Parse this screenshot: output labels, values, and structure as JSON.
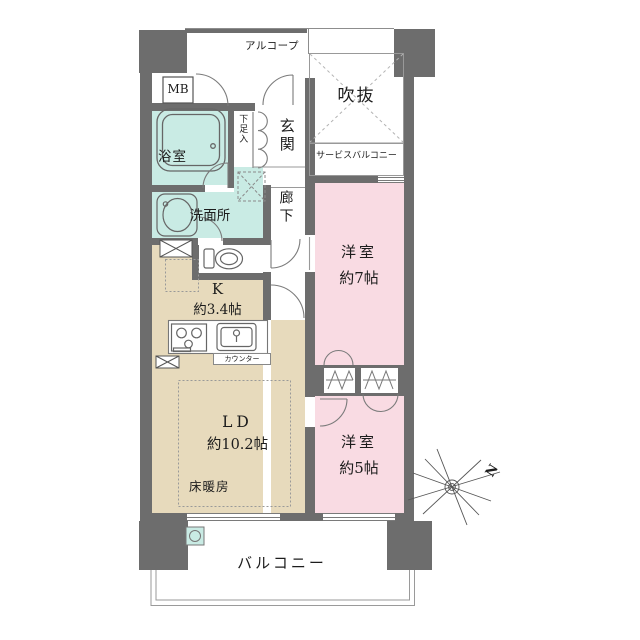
{
  "colors": {
    "wall": "#6d6d6d",
    "room_pink": "#f9dbe3",
    "room_tan": "#e7dabc",
    "room_teal": "#c9ebe4",
    "thin_line": "#8d8d8d",
    "text": "#1c1c1c"
  },
  "rooms": {
    "alcove": {
      "label": "アルコープ"
    },
    "meter_box": {
      "label": "MB"
    },
    "void": {
      "label": "吹抜"
    },
    "service_balcony": {
      "label": "サービスバルコニー"
    },
    "bathroom": {
      "label": "浴室"
    },
    "shoe_cabinet": {
      "label": "下足入"
    },
    "entrance": {
      "label": "玄関"
    },
    "washroom": {
      "label": "洗面所"
    },
    "corridor": {
      "label": "廊下"
    },
    "western_room_7": {
      "label": "洋室",
      "size": "約7帖"
    },
    "kitchen": {
      "label": "K",
      "size": "約3.4帖"
    },
    "counter": {
      "label": "カウンター"
    },
    "living_dining": {
      "label": "LD",
      "size": "約10.2帖"
    },
    "floor_heating": {
      "label": "床暖房"
    },
    "western_room_5": {
      "label": "洋室",
      "size": "約5帖"
    },
    "balcony": {
      "label": "バルコニー"
    }
  },
  "compass": {
    "north_label": "N"
  }
}
